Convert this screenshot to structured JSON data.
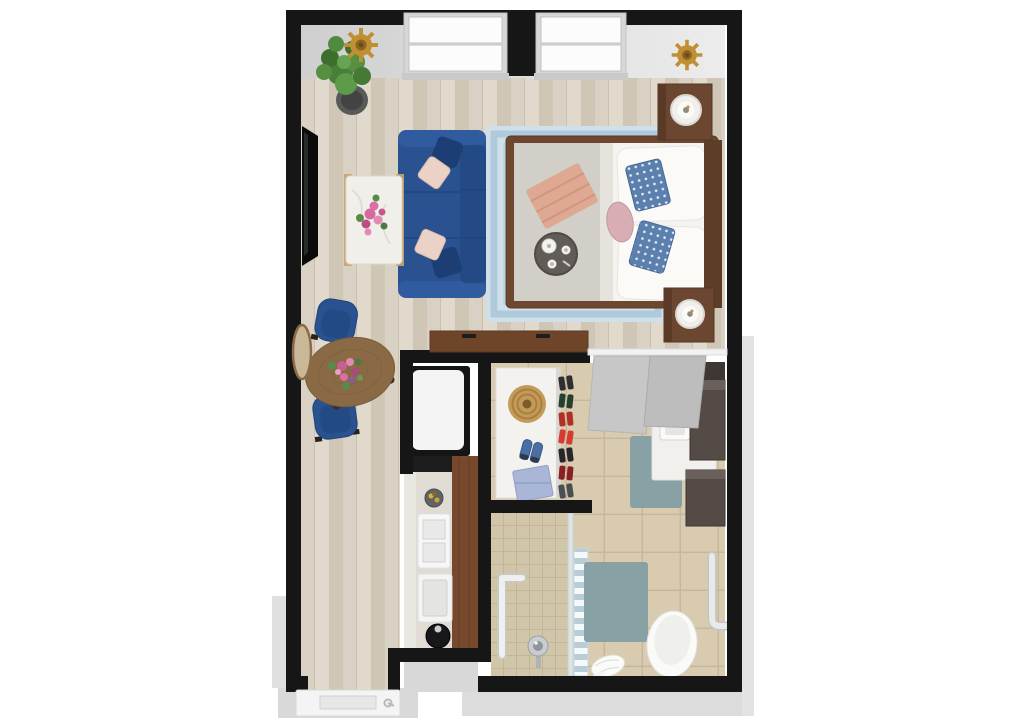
{
  "scene": {
    "type": "3d-floor-plan-top-view",
    "description": "studio apartment rendering: living/sleeping room, dining nook, kitchenette, walk-in closet, accessible bathroom, entry",
    "rooms": [
      {
        "name": "living-area",
        "items": [
          "wall-mounted-tv",
          "potted-plant",
          "blue-sofa",
          "navy-throw-pillows",
          "pink-throw-pillows",
          "marble-coffee-table",
          "pink-flower-bouquet",
          "gold-wall-medallion"
        ]
      },
      {
        "name": "sleeping-area",
        "items": [
          "double-hung-window",
          "double-hung-window",
          "gold-wall-medallion",
          "patterned-blue-area-rug",
          "bed-with-grey-blanket",
          "white-pillows",
          "blue-patterned-pillows",
          "round-pink-pillow",
          "folded-salmon-blanket",
          "breakfast-tray-with-tea-set",
          "nightstand-with-lamp",
          "nightstand-with-lamp",
          "wood-credenza"
        ]
      },
      {
        "name": "dining-nook",
        "items": [
          "round-wood-table",
          "flower-centerpiece",
          "blue-dining-chair",
          "blue-dining-chair",
          "round-wall-mirror"
        ]
      },
      {
        "name": "kitchenette",
        "items": [
          "refrigerator",
          "counter",
          "fruit-bowl",
          "double-sink",
          "cooktop",
          "round-black-basin",
          "wood-bar-counter"
        ]
      },
      {
        "name": "walk-in-closet",
        "items": [
          "white-shelf-unit",
          "woven-basket",
          "blue-sneakers",
          "blue-storage-box",
          "shoe-rack",
          "sliding-doors"
        ]
      },
      {
        "name": "bathroom",
        "items": [
          "vanity-counter-with-sink",
          "dark-cabinet-towers",
          "teal-rug",
          "walk-in-shower",
          "shower-grab-bar",
          "shower-head",
          "glass-partition",
          "striped-shower-curtain",
          "bath-rug",
          "toilet",
          "wall-grab-bar",
          "floor-towel"
        ]
      },
      {
        "name": "entry",
        "items": [
          "entry-door-with-handle"
        ]
      }
    ]
  },
  "colors": {
    "wall": "#161616",
    "outer_wall": "#dcdcdc",
    "wood_floor_a": "#d9d1c3",
    "wood_floor_b": "#e0d9cc",
    "wood_floor_c": "#cfc6b6",
    "tile_floor": "#d8cbb0",
    "tile_line": "#c5b79b",
    "shower_tile": "#d1c6aa",
    "bed_rug": "#cfe0ea",
    "bed_rug_border": "#a9c6d8",
    "bath_rug": "#87a1a5",
    "sofa": "#2a5291",
    "sofa_back": "#234a85",
    "pillow_navy": "#1d3e74",
    "pillow_pink": "#ecd2c6",
    "bed_frame": "#6d4730",
    "bed_blanket": "#d2cfc8",
    "bed_sheet": "#f4f3f0",
    "bed_pillow_blue": "#5b80ae",
    "round_pillow": "#d8aeb4",
    "throw_blanket": "#dfa892",
    "wood_dark": "#6b4630",
    "wood_mid": "#8a6a44",
    "wood_counter": "#76492c",
    "credenza": "#6e4528",
    "marble": "#f1efe9",
    "gold": "#c08f33",
    "plant_green": "#4f8a3e",
    "plant_pot": "#595959",
    "appliance_white": "#f4f4f4",
    "appliance_black": "#151515",
    "shelf_white": "#f3f2ef",
    "door_grey": "#c7c7c7",
    "basket_tan": "#c49a58",
    "box_blue": "#aab6d8",
    "vanity_dark": "#544a46",
    "toilet_white": "#fafaf8",
    "chrome": "#c9cdd0",
    "curtain_blue": "#b9cdd6",
    "flower_pink": "#d66a9e",
    "flower_magenta": "#b94f85",
    "leaf_green": "#5a8a4a",
    "track_white": "#f2f2f2",
    "entry_door": "#f4f4f4"
  }
}
